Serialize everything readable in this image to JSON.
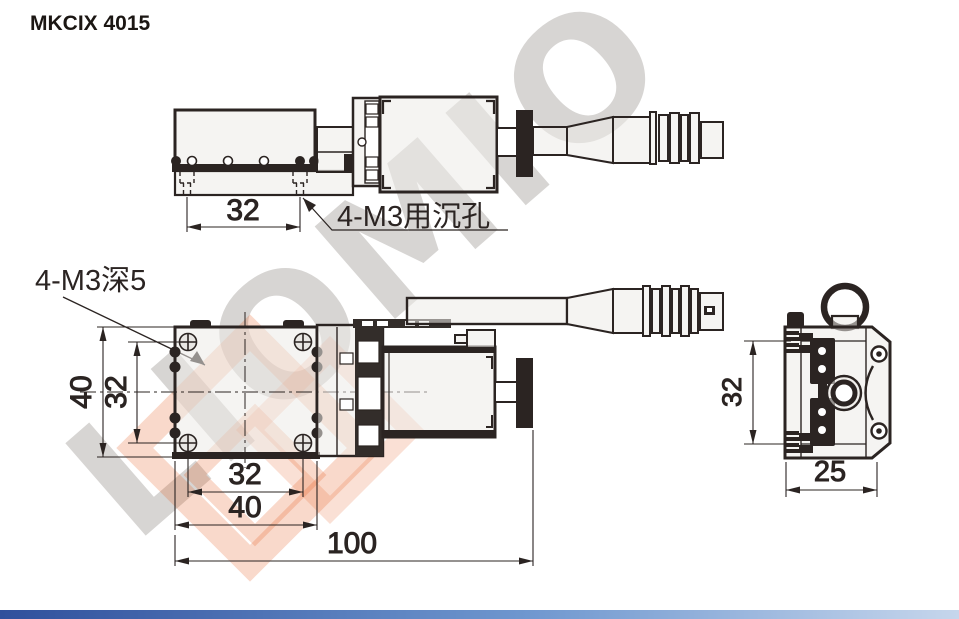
{
  "title": "MKCIX 4015",
  "watermark": {
    "text": "LIOMIO"
  },
  "labels": {
    "counterbore": "4-M3用沉孔",
    "tapped": "4-M3深5"
  },
  "dimensions": {
    "top_hole_spacing": "32",
    "front_height": "40",
    "front_hole_spacing_vertical": "32",
    "front_hole_spacing_horizontal": "32",
    "front_width": "40",
    "overall_length": "100",
    "side_height": "32",
    "side_depth": "25"
  },
  "colors": {
    "line": "#2b2422",
    "part_fill": "#efedea",
    "knob_fill": "#2b2422",
    "watermark_text": "#d7d5d3",
    "watermark_logo": "#e4521a",
    "footer_bar_left": "#30509c",
    "footer_bar_right": "#c6d6ec"
  }
}
